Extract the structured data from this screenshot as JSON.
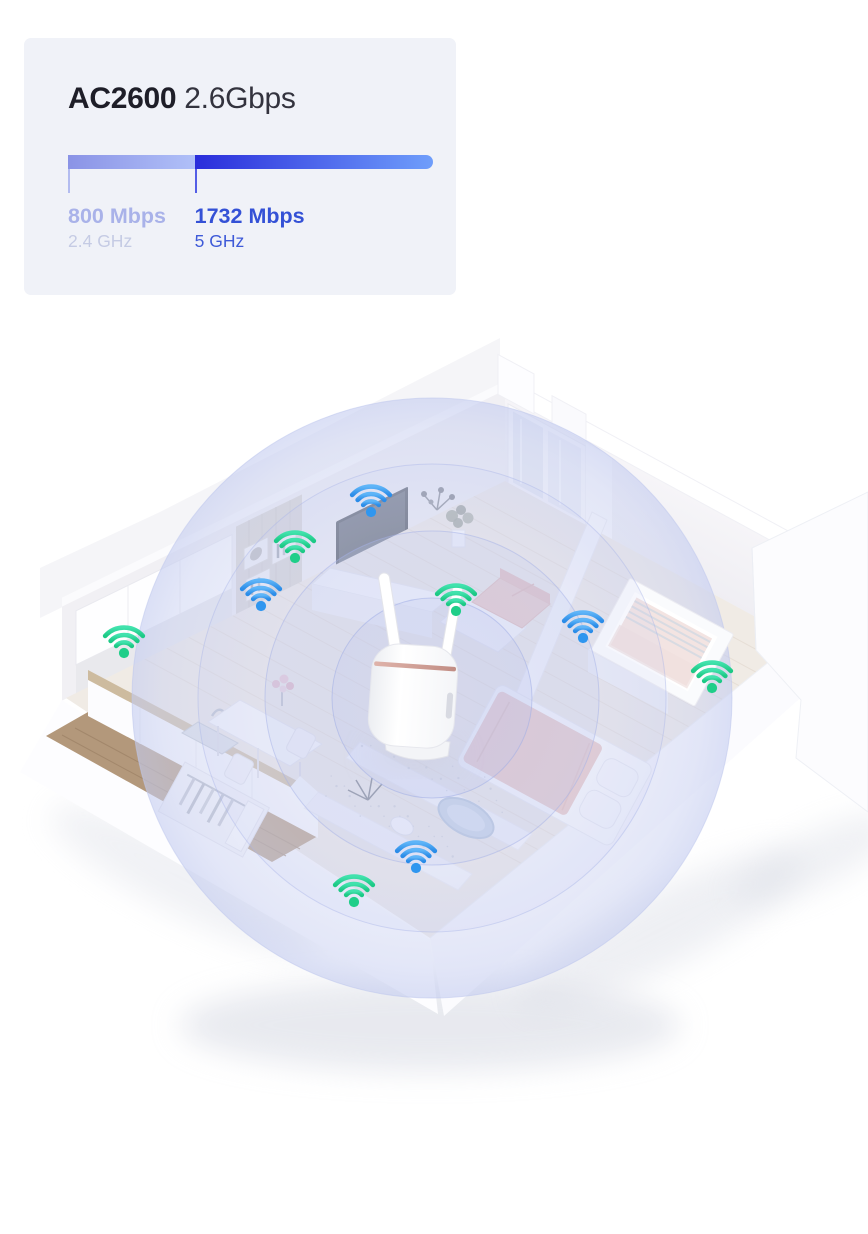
{
  "card": {
    "background": "#f0f2f8",
    "title": {
      "model": "AC2600",
      "speed": "2.6Gbps"
    },
    "bar": {
      "segments": [
        {
          "label": "800 Mbps",
          "sublabel": "2.4 GHz",
          "fraction": 0.347,
          "gradient": [
            "#8a93e6",
            "#b0c0f8"
          ],
          "label_color": "#a9b2e9",
          "sublabel_color": "#c5cbe4",
          "tick_color": "#b3bcf0"
        },
        {
          "label": "1732 Mbps",
          "sublabel": "5 GHz",
          "fraction": 0.653,
          "gradient": [
            "#2a2ddb",
            "#6f9efb"
          ],
          "label_color": "#3451d6",
          "sublabel_color": "#3e5ad8",
          "tick_color": "#545ee6"
        }
      ]
    }
  },
  "illustration": {
    "router": {
      "name": "wifi-router-with-two-antennas",
      "accent_stripe_color": "#d2a29a"
    },
    "coverage": {
      "ring_color": "#c7cfef",
      "dome_color": "#cdd4f0",
      "rings": 3
    },
    "wifi_colors": {
      "green": [
        "#41e2ad",
        "#1cc985",
        "#1fce89"
      ],
      "blue": [
        "#5fb5f8",
        "#2b8ce8",
        "#2f96ef"
      ]
    },
    "wifi_icons": [
      {
        "variant": "blue",
        "x": 371,
        "y": 512
      },
      {
        "variant": "green",
        "x": 295,
        "y": 558
      },
      {
        "variant": "blue",
        "x": 261,
        "y": 606
      },
      {
        "variant": "green",
        "x": 456,
        "y": 611
      },
      {
        "variant": "blue",
        "x": 583,
        "y": 638
      },
      {
        "variant": "green",
        "x": 712,
        "y": 688
      },
      {
        "variant": "green",
        "x": 124,
        "y": 653
      },
      {
        "variant": "blue",
        "x": 416,
        "y": 868
      },
      {
        "variant": "green",
        "x": 354,
        "y": 902
      }
    ]
  }
}
